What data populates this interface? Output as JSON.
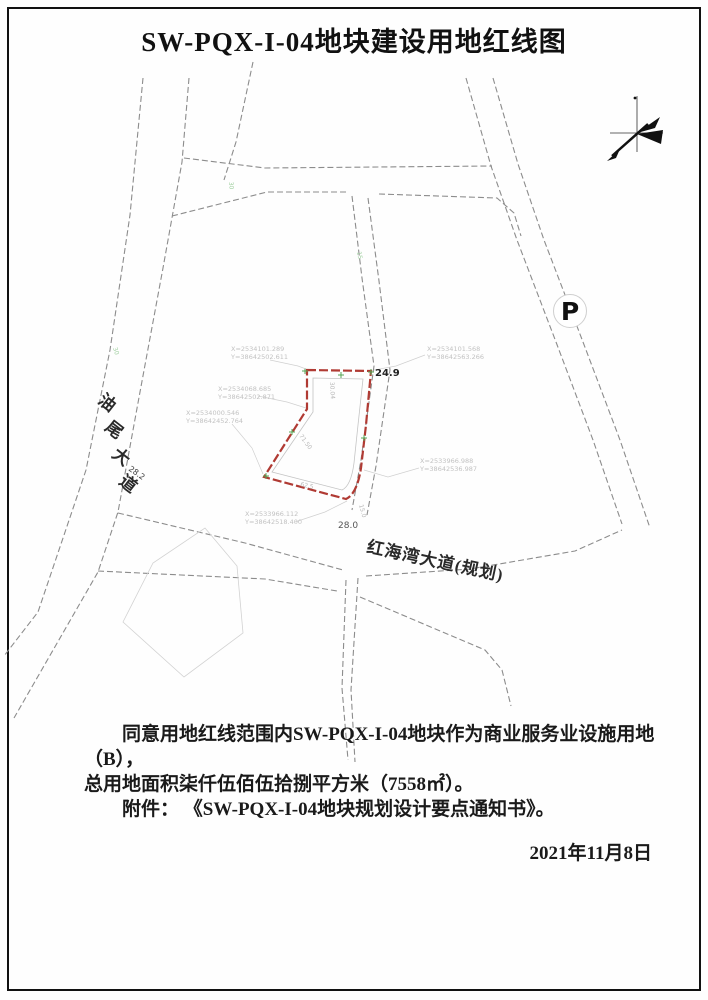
{
  "title": "SW-PQX-I-04地块建设用地红线图",
  "colors": {
    "redline": "#b03a33",
    "road_dash": "#8c8c8c",
    "faint_gray": "#c2c2c2",
    "survey_green": "#56a556"
  },
  "map": {
    "parking_label": "P",
    "roads": {
      "youwei_dadao": {
        "label": "油尾大道",
        "chars": [
          "油",
          "尾",
          "大",
          "道"
        ],
        "width_label": "28.2"
      },
      "honghaiwan_dadao": {
        "label": "红海湾大道(规划)",
        "width_label": "28.0"
      },
      "middle_road": {
        "width_label": "24.9"
      }
    },
    "road_width_marks": {
      "left": "30",
      "top": "30",
      "middle": "15"
    },
    "plot": {
      "dimensions": [
        "30.04",
        "71.50",
        "62.5",
        "15.0"
      ],
      "coordinates": [
        {
          "x": "X=2534101.289",
          "y": "Y=38642502.611"
        },
        {
          "x": "X=2534101.568",
          "y": "Y=38642563.266"
        },
        {
          "x": "X=2534068.685",
          "y": "Y=38642502.871"
        },
        {
          "x": "X=2534000.546",
          "y": "Y=38642452.764"
        },
        {
          "x": "X=2533966.988",
          "y": "Y=38642536.987"
        },
        {
          "x": "X=2533966.112",
          "y": "Y=38642518.400"
        }
      ]
    }
  },
  "notes": {
    "line1": "同意用地红线范围内SW-PQX-I-04地块作为商业服务业设施用地（B），",
    "line2": "总用地面积柒仟伍佰伍拾捌平方米（7558㎡）。",
    "line3": "附件： 《SW-PQX-I-04地块规划设计要点通知书》。",
    "date": "2021年11月8日"
  }
}
